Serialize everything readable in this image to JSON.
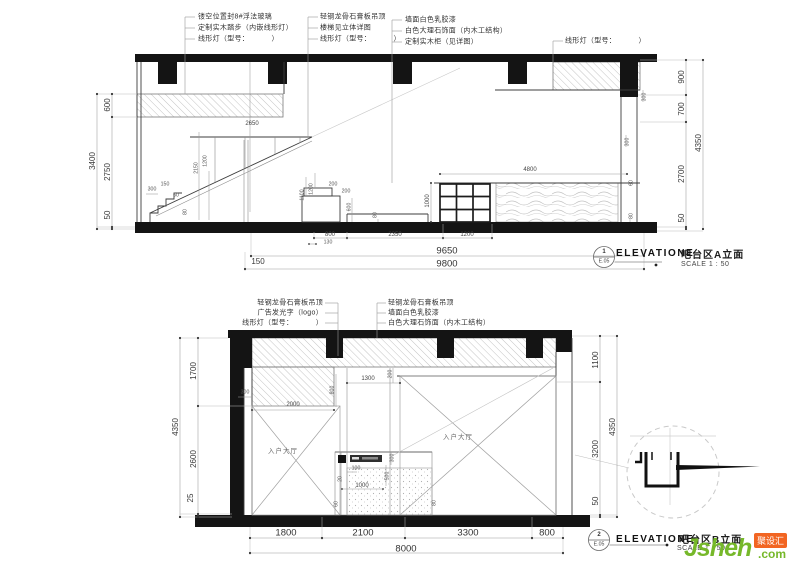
{
  "callouts": {
    "elevation_word": "ELEVATIONE",
    "scale_text": "SCALE 1 : 50",
    "sheet_no": "E.05",
    "a": {
      "number": "1",
      "title": "吧台区A立面"
    },
    "b": {
      "number": "2",
      "title": "吧台区B立面"
    }
  },
  "watermark": {
    "brand": "Jsheh",
    "tld": ".com",
    "badge": "聚设汇",
    "brand_color": "#76b82a",
    "badge_color": "#f26522"
  },
  "room_label": "入户大厅",
  "elev_a": {
    "notes": {
      "g1": [
        "镂空位置封8#浮法玻璃",
        "定制实木踏步（内嵌线形灯）",
        "线形灯（型号：          ）"
      ],
      "g2": [
        "轻钢龙骨石膏板吊顶",
        "楼梯见立体详图",
        "线形灯（型号：          ）"
      ],
      "g3": [
        "墙面白色乳胶漆",
        "白色大理石饰面（内木工结构）",
        "定制实木柜（见详图）"
      ],
      "g4": [
        "线形灯（型号：          ）"
      ]
    },
    "dims": {
      "left": [
        "600",
        "2750",
        "50"
      ],
      "left_total": "3400",
      "right": [
        "900",
        "700",
        "2700",
        "50"
      ],
      "right_total": "4350",
      "bottom": {
        "b1": "9650",
        "b2a": "150",
        "b2b": "9800"
      },
      "floor": [
        "800",
        "2350",
        "1200",
        "130"
      ],
      "inner": [
        "2650",
        "300",
        "2150",
        "1200",
        "150",
        "60",
        "80",
        "200",
        "200",
        "1100",
        "1200",
        "600",
        "80",
        "1000",
        "4800",
        "60",
        "80",
        "300",
        "300"
      ]
    }
  },
  "elev_b": {
    "notes": {
      "gl": [
        "轻钢龙骨石膏板吊顶",
        "广告发光字（logo）",
        "线形灯（型号：          ）"
      ],
      "gr": [
        "轻钢龙骨石膏板吊顶",
        "墙面白色乳胶漆",
        "白色大理石饰面（内木工结构）"
      ]
    },
    "dims": {
      "left": [
        "1700",
        "2600",
        "25"
      ],
      "left_total": "4350",
      "right": [
        "1100",
        "3200",
        "50"
      ],
      "right_total": "4350",
      "bottom": [
        "1800",
        "2100",
        "3300",
        "800"
      ],
      "bottom_total": "8000",
      "inner": [
        "300",
        "2000",
        "800",
        "1300",
        "200",
        "100",
        "20",
        "1000",
        "500",
        "300",
        "60",
        "80"
      ]
    }
  }
}
